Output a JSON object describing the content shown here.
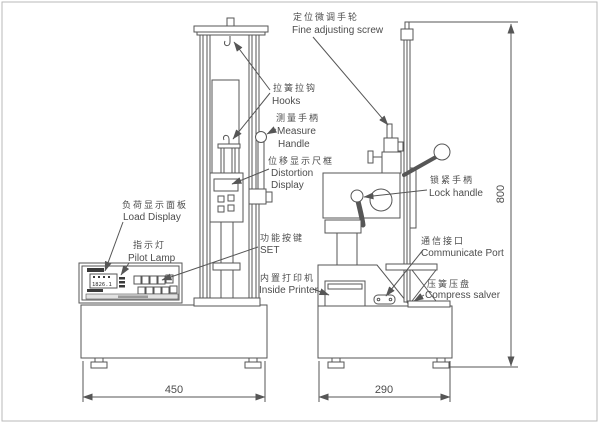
{
  "drawing": {
    "labels": {
      "fine_adjusting": {
        "zh": "定位微调手轮",
        "en": "Fine adjusting screw"
      },
      "hooks": {
        "zh": "拉簧拉钩",
        "en": "Hooks"
      },
      "measure_handle": {
        "zh": "测量手柄",
        "en1": "Measure",
        "en2": "Handle"
      },
      "distortion_display": {
        "zh": "位移显示尺框",
        "en1": "Distortion",
        "en2": "Display"
      },
      "load_display": {
        "zh": "负荷显示面板",
        "en": "Load Display"
      },
      "pilot_lamp": {
        "zh": "指示灯",
        "en": "Pilot Lamp"
      },
      "function_keys": {
        "zh": "功能按键",
        "en": "SET"
      },
      "inside_printer": {
        "zh": "内置打印机",
        "en": "Inside Printer"
      },
      "lock_handle": {
        "zh": "锁紧手柄",
        "en": "Lock handle"
      },
      "communicate_port": {
        "zh": "通信接口",
        "en": "Communicate Port"
      },
      "compress_salver": {
        "zh": "压簧压盘",
        "en": "Compress salver"
      }
    },
    "dimensions": {
      "base_width_front": "450",
      "base_width_side": "290",
      "column_height": "800"
    },
    "load_display_value": "1826.1",
    "colors": {
      "line": "#565656",
      "background": "#ffffff",
      "frame": "#b9b9b9"
    }
  }
}
